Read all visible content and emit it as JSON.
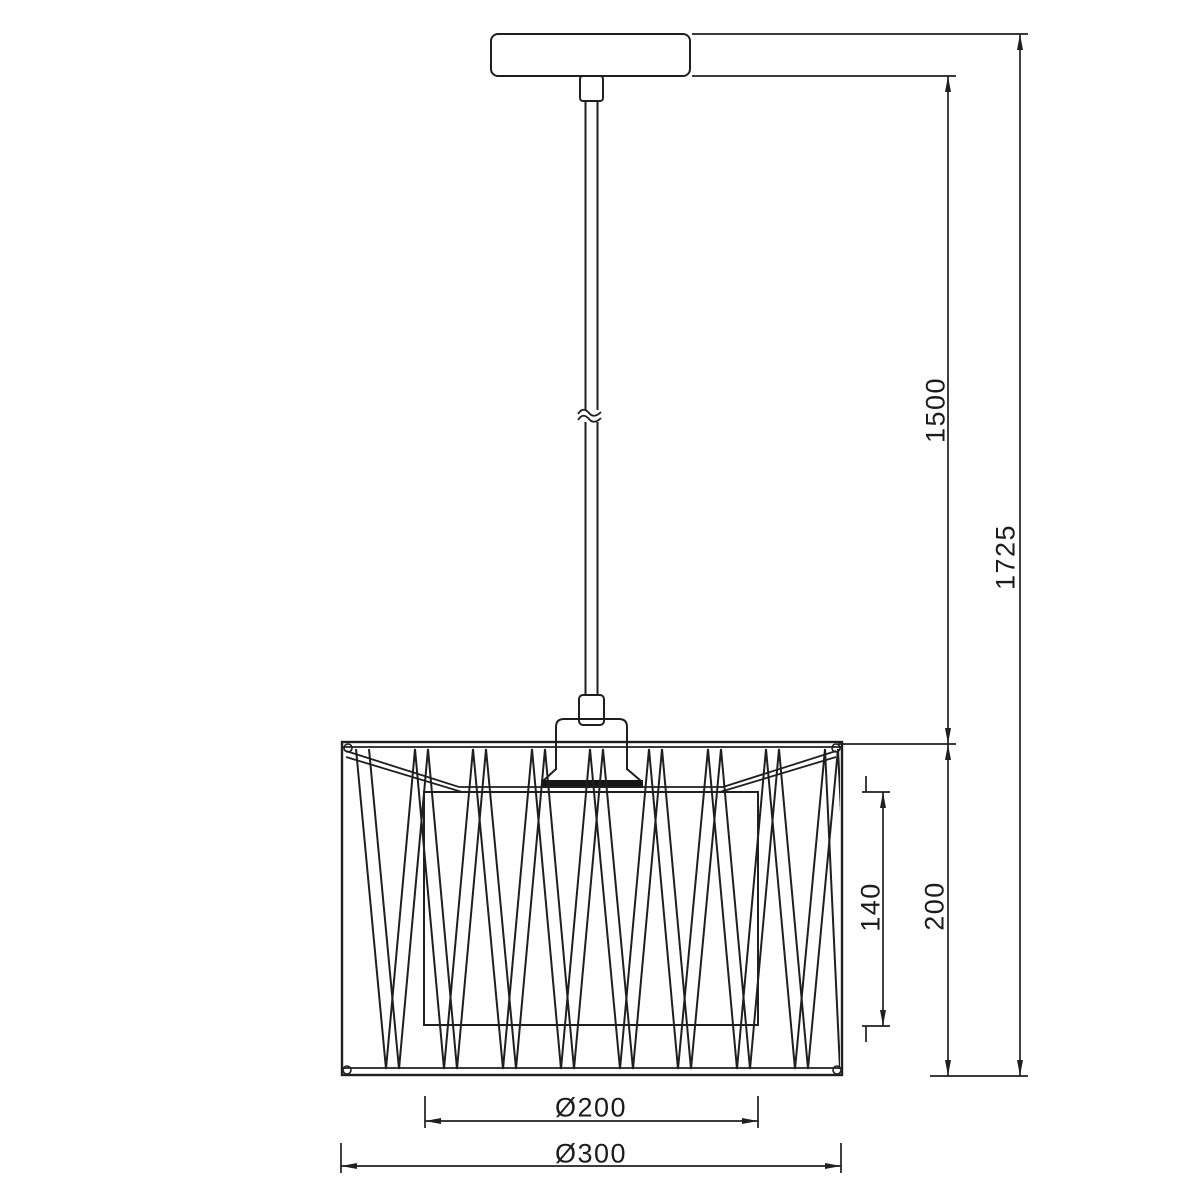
{
  "drawing": {
    "subject": "pendant-lamp-front-elevation",
    "colors": {
      "line": "#1f1f1f",
      "background": "#ffffff",
      "socket_band": "#161616"
    }
  },
  "dimensions": {
    "suspension_length": "1500",
    "overall_height": "1725",
    "shade_height": "200",
    "inner_shade_height": "140",
    "inner_shade_diameter": "Ø200",
    "shade_diameter": "Ø300"
  }
}
